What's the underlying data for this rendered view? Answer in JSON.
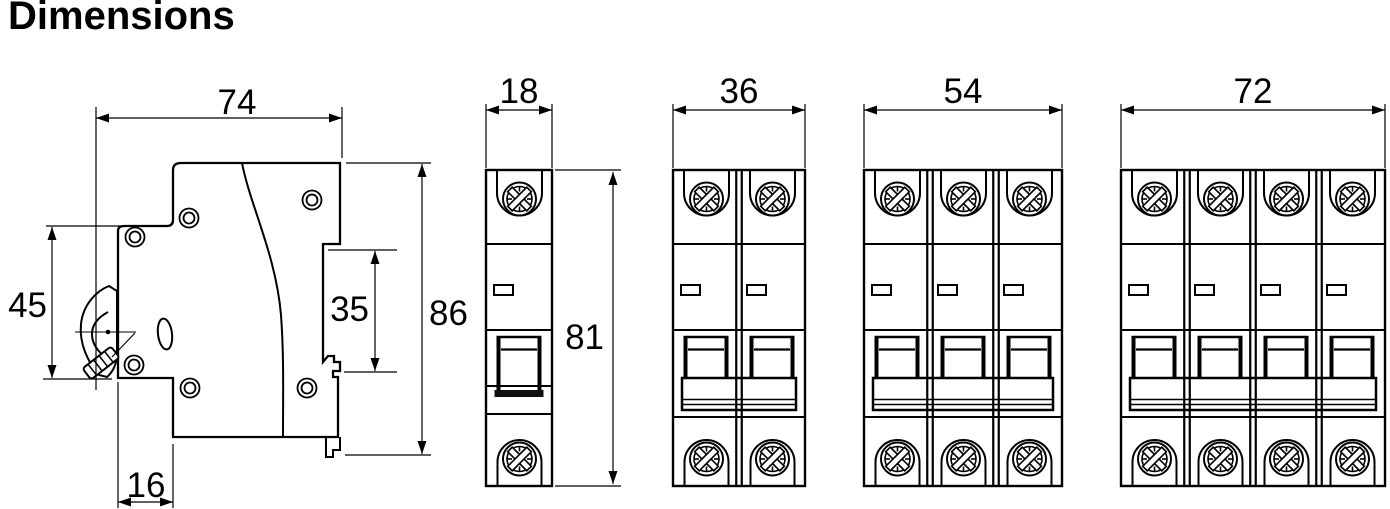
{
  "title": "Dimensions",
  "side_view": {
    "name": "side-profile",
    "width": "74",
    "front_height": "45",
    "din_recess_height": "35",
    "overall_height": "86",
    "base_depth": "16"
  },
  "front_views": [
    {
      "name": "1-pole",
      "poles": 1,
      "width": "18",
      "height": "81"
    },
    {
      "name": "2-pole",
      "poles": 2,
      "width": "36"
    },
    {
      "name": "3-pole",
      "poles": 3,
      "width": "54"
    },
    {
      "name": "4-pole",
      "poles": 4,
      "width": "72"
    }
  ],
  "colors": {
    "line": "#000000",
    "background": "#ffffff"
  }
}
